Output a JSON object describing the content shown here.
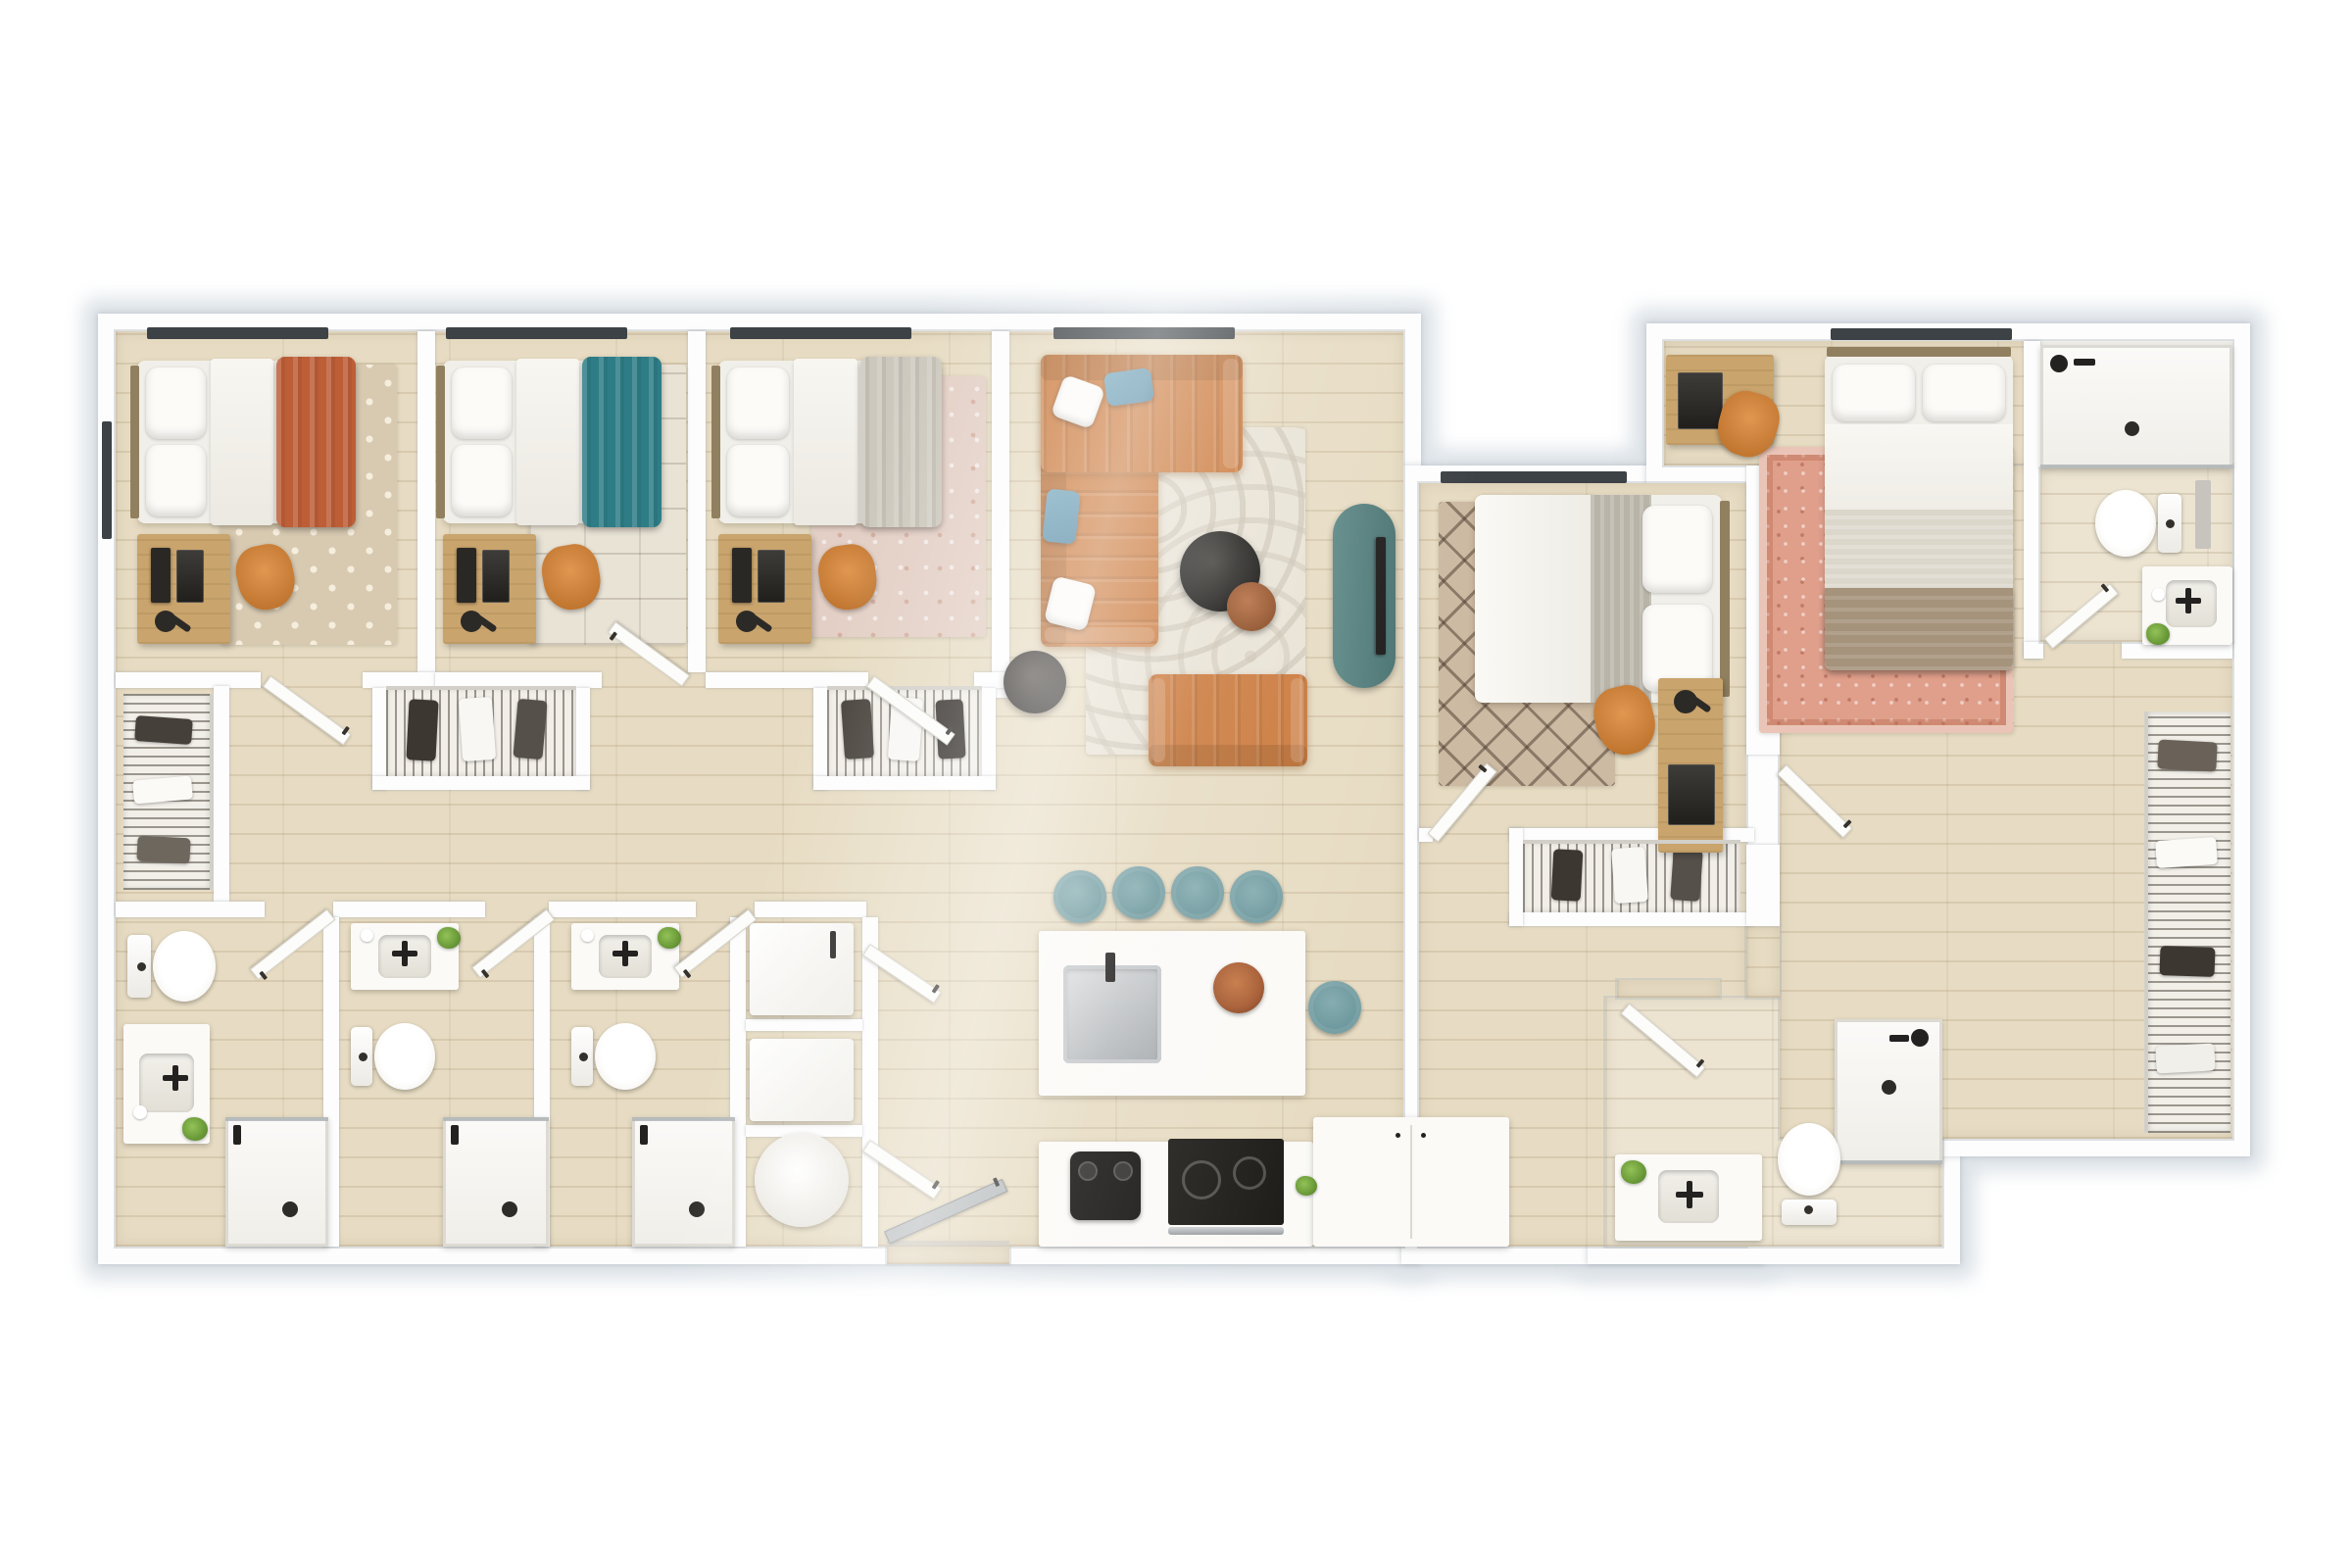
{
  "palette": {
    "page_bg": "#ffffff",
    "wall": "#fdfdfd",
    "wall_halo": "#dde3e8",
    "wood_floor": "#e7dcc3",
    "wood_floor_light": "#ece4d1",
    "white_surface": "#f7f6f2",
    "sofa_leather": "#cb7a3d",
    "accent_chair": "#d8883f",
    "teal_blanket": "#2e7d86",
    "teal_stool": "#6a969b",
    "teal_console": "#5d8886",
    "rust_blanket": "#bd5e37",
    "gray_coverlet": "#ccc8bd",
    "tan_blanket": "#a5937c",
    "desk_wood": "#c9a46d",
    "rug_cream": "#e9e3d6",
    "rug_taupe": "#d8cab1",
    "rug_blush": "#e3cfc5",
    "rug_trellis": "#cdbaa3",
    "rug_salmon": "#df9f8b",
    "window_frame": "#3d4246",
    "entry_door": "#b7bbbd",
    "plant_green": "#5d8c2e",
    "copper": "#a55a31"
  },
  "plan": {
    "title": "3D top-view apartment floor plan, 5 bedrooms / 5 bathrooms",
    "counts": {
      "bedrooms": 5,
      "bathrooms": 5,
      "counter_stools": 5
    },
    "rooms": {
      "bedroom1": {
        "name": "Bedroom 1",
        "accent": "rust",
        "furniture": [
          "full bed with rust throw blanket",
          "desk with monitor and task lamp",
          "orange desk chair",
          "cross-motif area rug",
          "tall wire-shelf closet",
          "window"
        ]
      },
      "bedroom2": {
        "name": "Bedroom 2",
        "accent": "teal",
        "furniture": [
          "full bed with teal throw blanket",
          "desk with monitor and task lamp",
          "orange desk chair",
          "line-motif cream rug",
          "wire-shelf closet",
          "window"
        ]
      },
      "bedroom3": {
        "name": "Bedroom 3",
        "accent": "gray",
        "furniture": [
          "full bed with gray coverlet",
          "desk with monitor and task lamp",
          "orange desk chair",
          "blush vintage rug",
          "wire-shelf closet",
          "window"
        ]
      },
      "bedroom4": {
        "name": "Bedroom 4",
        "accent": "neutral",
        "furniture": [
          "full bed",
          "diamond-trellis rug",
          "desk with lamp and laptop",
          "orange desk chair",
          "wire-shelf closet",
          "window"
        ]
      },
      "bedroom5": {
        "name": "Bedroom 5",
        "accent": "tan",
        "furniture": [
          "full bed with tan blanket",
          "salmon oriental rug",
          "desk with lamp and laptop",
          "orange desk chair",
          "wire wardrobe wall",
          "window"
        ]
      },
      "living": {
        "name": "Living Room",
        "furniture": [
          "orange leather L-sectional",
          "white and teal throw pillows",
          "cream wave-pattern rug",
          "round black coffee table",
          "round rust accent table",
          "round charcoal side table",
          "orange leather loveseat",
          "teal oval media console with TV"
        ]
      },
      "kitchen": {
        "name": "Kitchen",
        "furniture": [
          "island with stainless sink and faucet",
          "copper bowl",
          "5 teal counter stools",
          "range with oven handle",
          "black coffee maker",
          "refrigerator counter run",
          "base cabinets"
        ]
      },
      "bath1": {
        "name": "Bathroom 1",
        "furniture": [
          "toilet",
          "vanity with sink",
          "walk-in shower",
          "plant"
        ]
      },
      "bath2": {
        "name": "Bathroom 2",
        "furniture": [
          "toilet",
          "vanity with sink",
          "walk-in shower",
          "plant"
        ]
      },
      "bath3": {
        "name": "Bathroom 3",
        "furniture": [
          "toilet",
          "vanity with sink",
          "walk-in shower",
          "plant"
        ]
      },
      "bath4": {
        "name": "Bathroom 4 (top right)",
        "furniture": [
          "walk-in shower",
          "toilet",
          "vanity with sink",
          "plant"
        ]
      },
      "bath5": {
        "name": "Bathroom 5 (bottom right)",
        "furniture": [
          "walk-in shower",
          "toilet",
          "vanity with sink",
          "plant"
        ]
      },
      "laundry": {
        "name": "Utility Closet",
        "furniture": [
          "stacked washer",
          "stacked dryer",
          "round water heater"
        ]
      },
      "hall": {
        "name": "Hallway / Entry",
        "furniture": [
          "gray entry door",
          "interior doors"
        ]
      }
    }
  }
}
